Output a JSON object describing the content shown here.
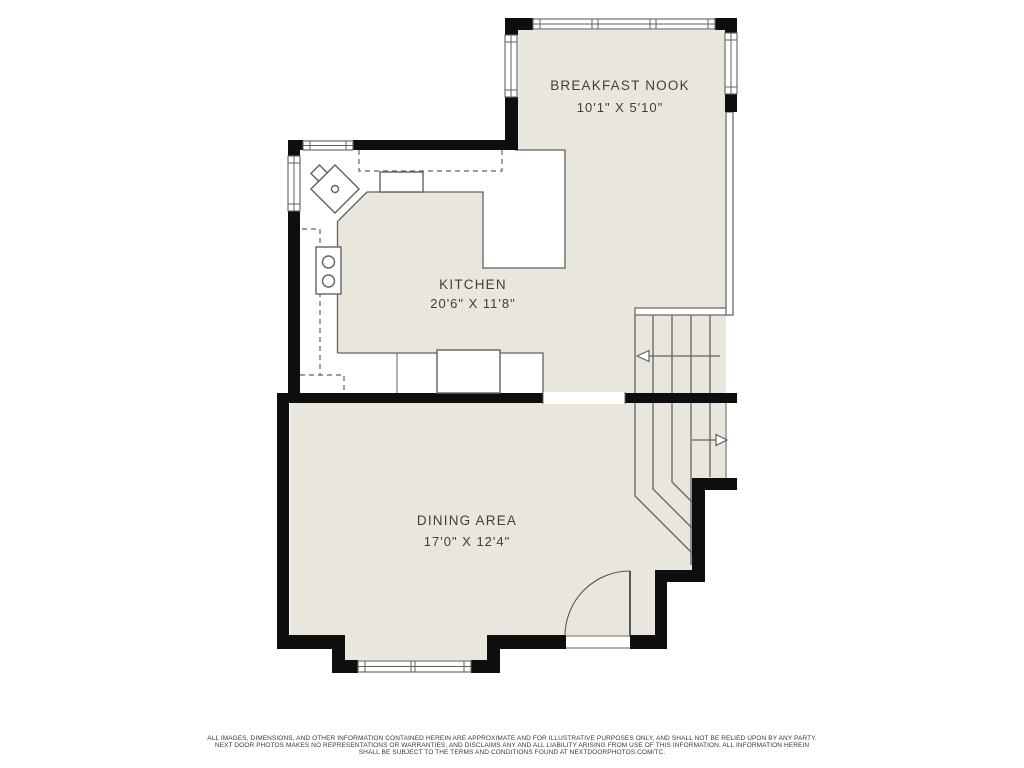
{
  "colors": {
    "floor": "#e9e6dd",
    "wall": "#0e0e0e",
    "line": "#63625f",
    "text": "#3e3e40"
  },
  "rooms": {
    "breakfast_nook": {
      "name": "BREAKFAST NOOK",
      "dims": "10'1\" X 5'10\""
    },
    "kitchen": {
      "name": "KITCHEN",
      "dims": "20'6\" X 11'8\""
    },
    "dining_area": {
      "name": "DINING AREA",
      "dims": "17'0\" X 12'4\""
    }
  },
  "fixtures": {
    "sink": "corner-sink",
    "range": "range-burners",
    "appliance": "dishwasher",
    "stairs_up_arrow": "stair-arrow-left",
    "stairs_down_arrow": "stair-arrow-right",
    "door": "door-swing"
  },
  "footer": {
    "line1": "ALL IMAGES, DIMENSIONS, AND OTHER INFORMATION CONTAINED HEREIN ARE APPROXIMATE AND FOR ILLUSTRATIVE PURPOSES ONLY, AND SHALL NOT BE RELIED UPON BY ANY PARTY.",
    "line2": "NEXT DOOR PHOTOS MAKES NO REPRESENTATIONS OR WARRANTIES, AND DISCLAIMS ANY AND ALL LIABILITY ARISING FROM USE OF THIS INFORMATION. ALL INFORMATION HEREIN",
    "line3": "SHALL BE SUBJECT TO THE TERMS AND CONDITIONS FOUND AT NEXTDOORPHOTOS.COM/TC."
  }
}
